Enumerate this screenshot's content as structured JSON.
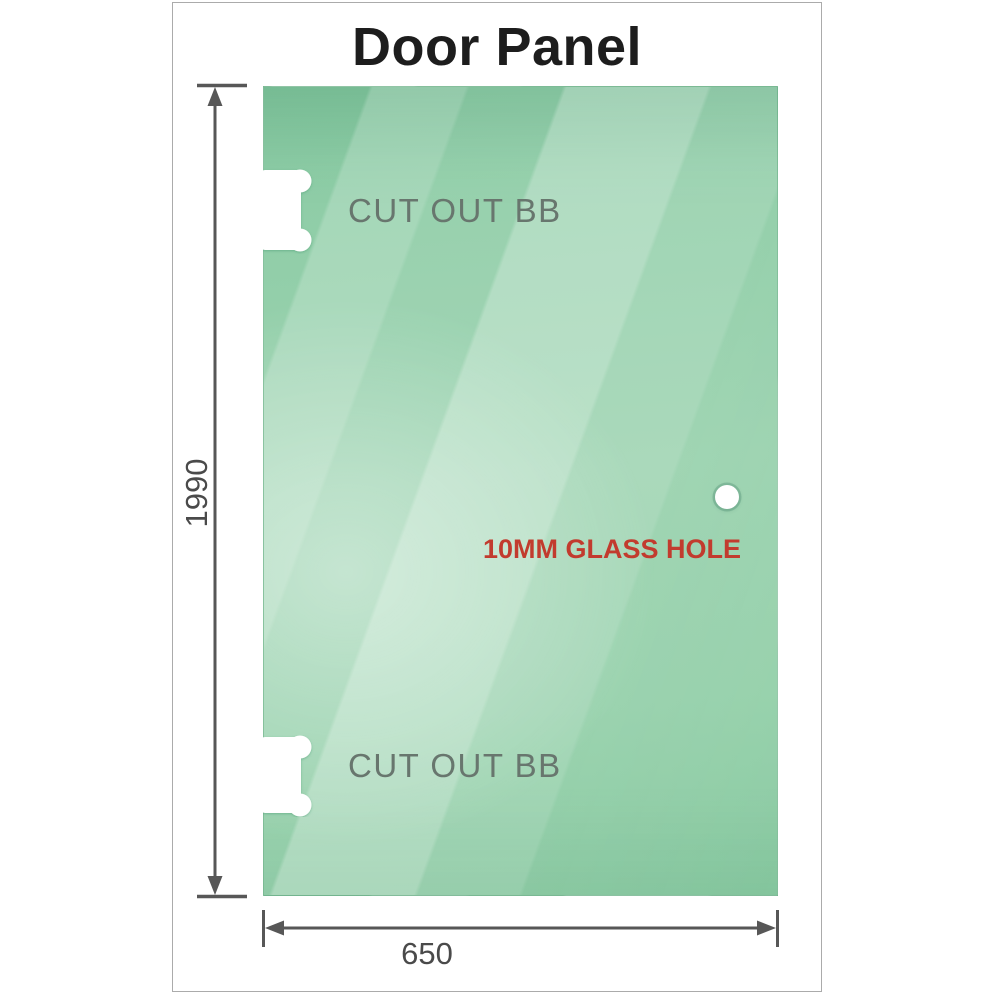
{
  "title": "Door Panel",
  "panel": {
    "cutouts": [
      {
        "label": "CUT OUT BB"
      },
      {
        "label": "CUT OUT BB"
      }
    ],
    "glass_hole_label": "10MM GLASS HOLE"
  },
  "dimensions": {
    "height": "1990",
    "width": "650"
  },
  "colors": {
    "glass_green": "#8ecba6",
    "label_red": "#c23b2e",
    "dimension_gray": "#575757",
    "cutout_text_gray": "#68766e",
    "frame_border_gray": "#ababab"
  }
}
